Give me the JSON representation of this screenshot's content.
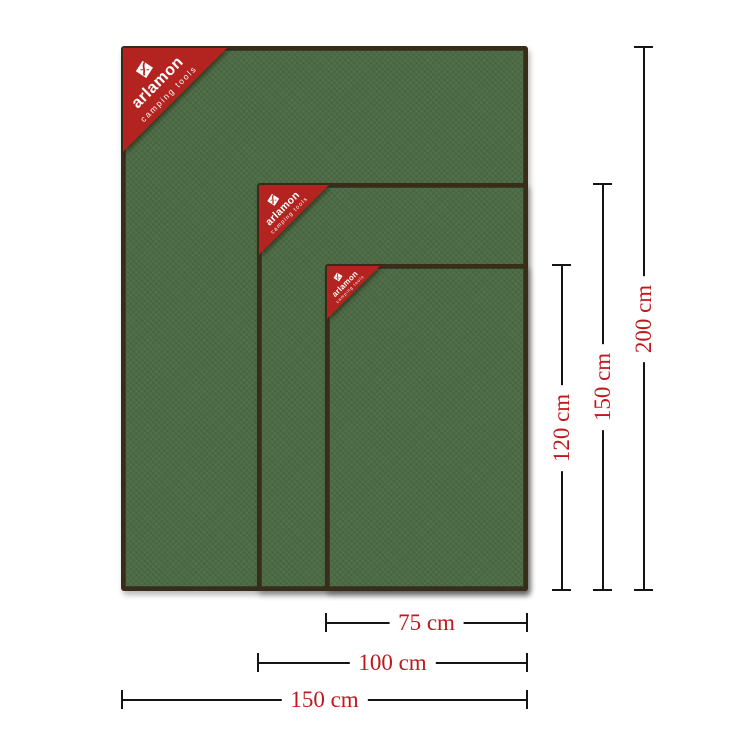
{
  "brand": {
    "name": "arlamon",
    "tagline": "camping tools"
  },
  "products": [
    {
      "id": "blanket-150x200",
      "width_cm": 150,
      "height_cm": 200
    },
    {
      "id": "blanket-100x150",
      "width_cm": 100,
      "height_cm": 150
    },
    {
      "id": "blanket-75x120",
      "width_cm": 75,
      "height_cm": 120
    }
  ],
  "dimensions": {
    "vertical": [
      {
        "label": "120 cm"
      },
      {
        "label": "150 cm"
      },
      {
        "label": "200 cm"
      }
    ],
    "horizontal": [
      {
        "label": "75 cm"
      },
      {
        "label": "100 cm"
      },
      {
        "label": "150 cm"
      }
    ]
  },
  "colors": {
    "background": "#ffffff",
    "fabric_green": "#4d6c46",
    "blanket_border": "#392c1b",
    "badge_red": "#b3231f",
    "badge_text": "#ffffff",
    "dimension_line": "#141414",
    "dimension_text": "#c0181c"
  }
}
